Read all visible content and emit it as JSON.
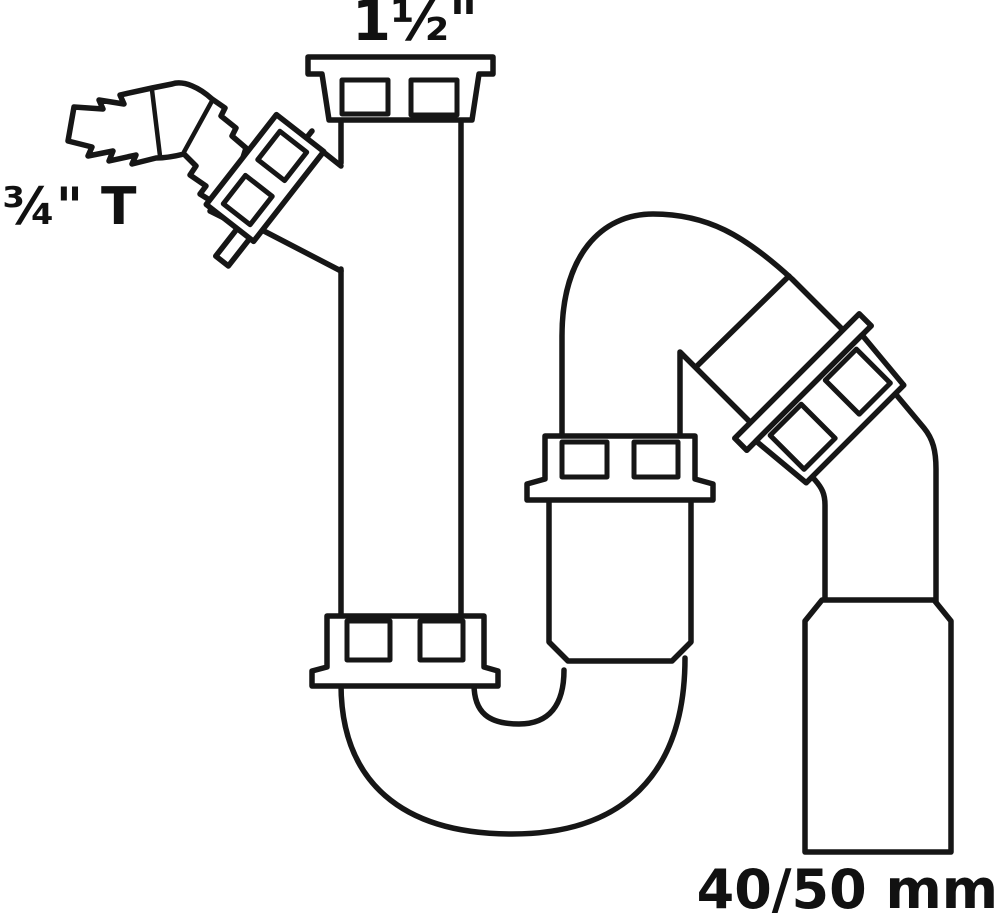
{
  "diagram": {
    "type": "plumbing-trap-technical-drawing",
    "labels": {
      "inlet_top": "1½\"",
      "branch_left": "¾\" T",
      "outlet_bottom": "40/50 mm"
    },
    "parts": [
      "inlet-union-nut",
      "washing-machine-hose-barb",
      "branch-union-nut",
      "vertical-inlet-pipe",
      "lower-union-nut",
      "u-bend-trap",
      "trap-cup-body",
      "trap-union-nut",
      "angled-union-nut",
      "outlet-elbow",
      "outlet-adapter-40-50"
    ],
    "colors": {
      "line": "#161616",
      "background": "#ffffff"
    }
  }
}
